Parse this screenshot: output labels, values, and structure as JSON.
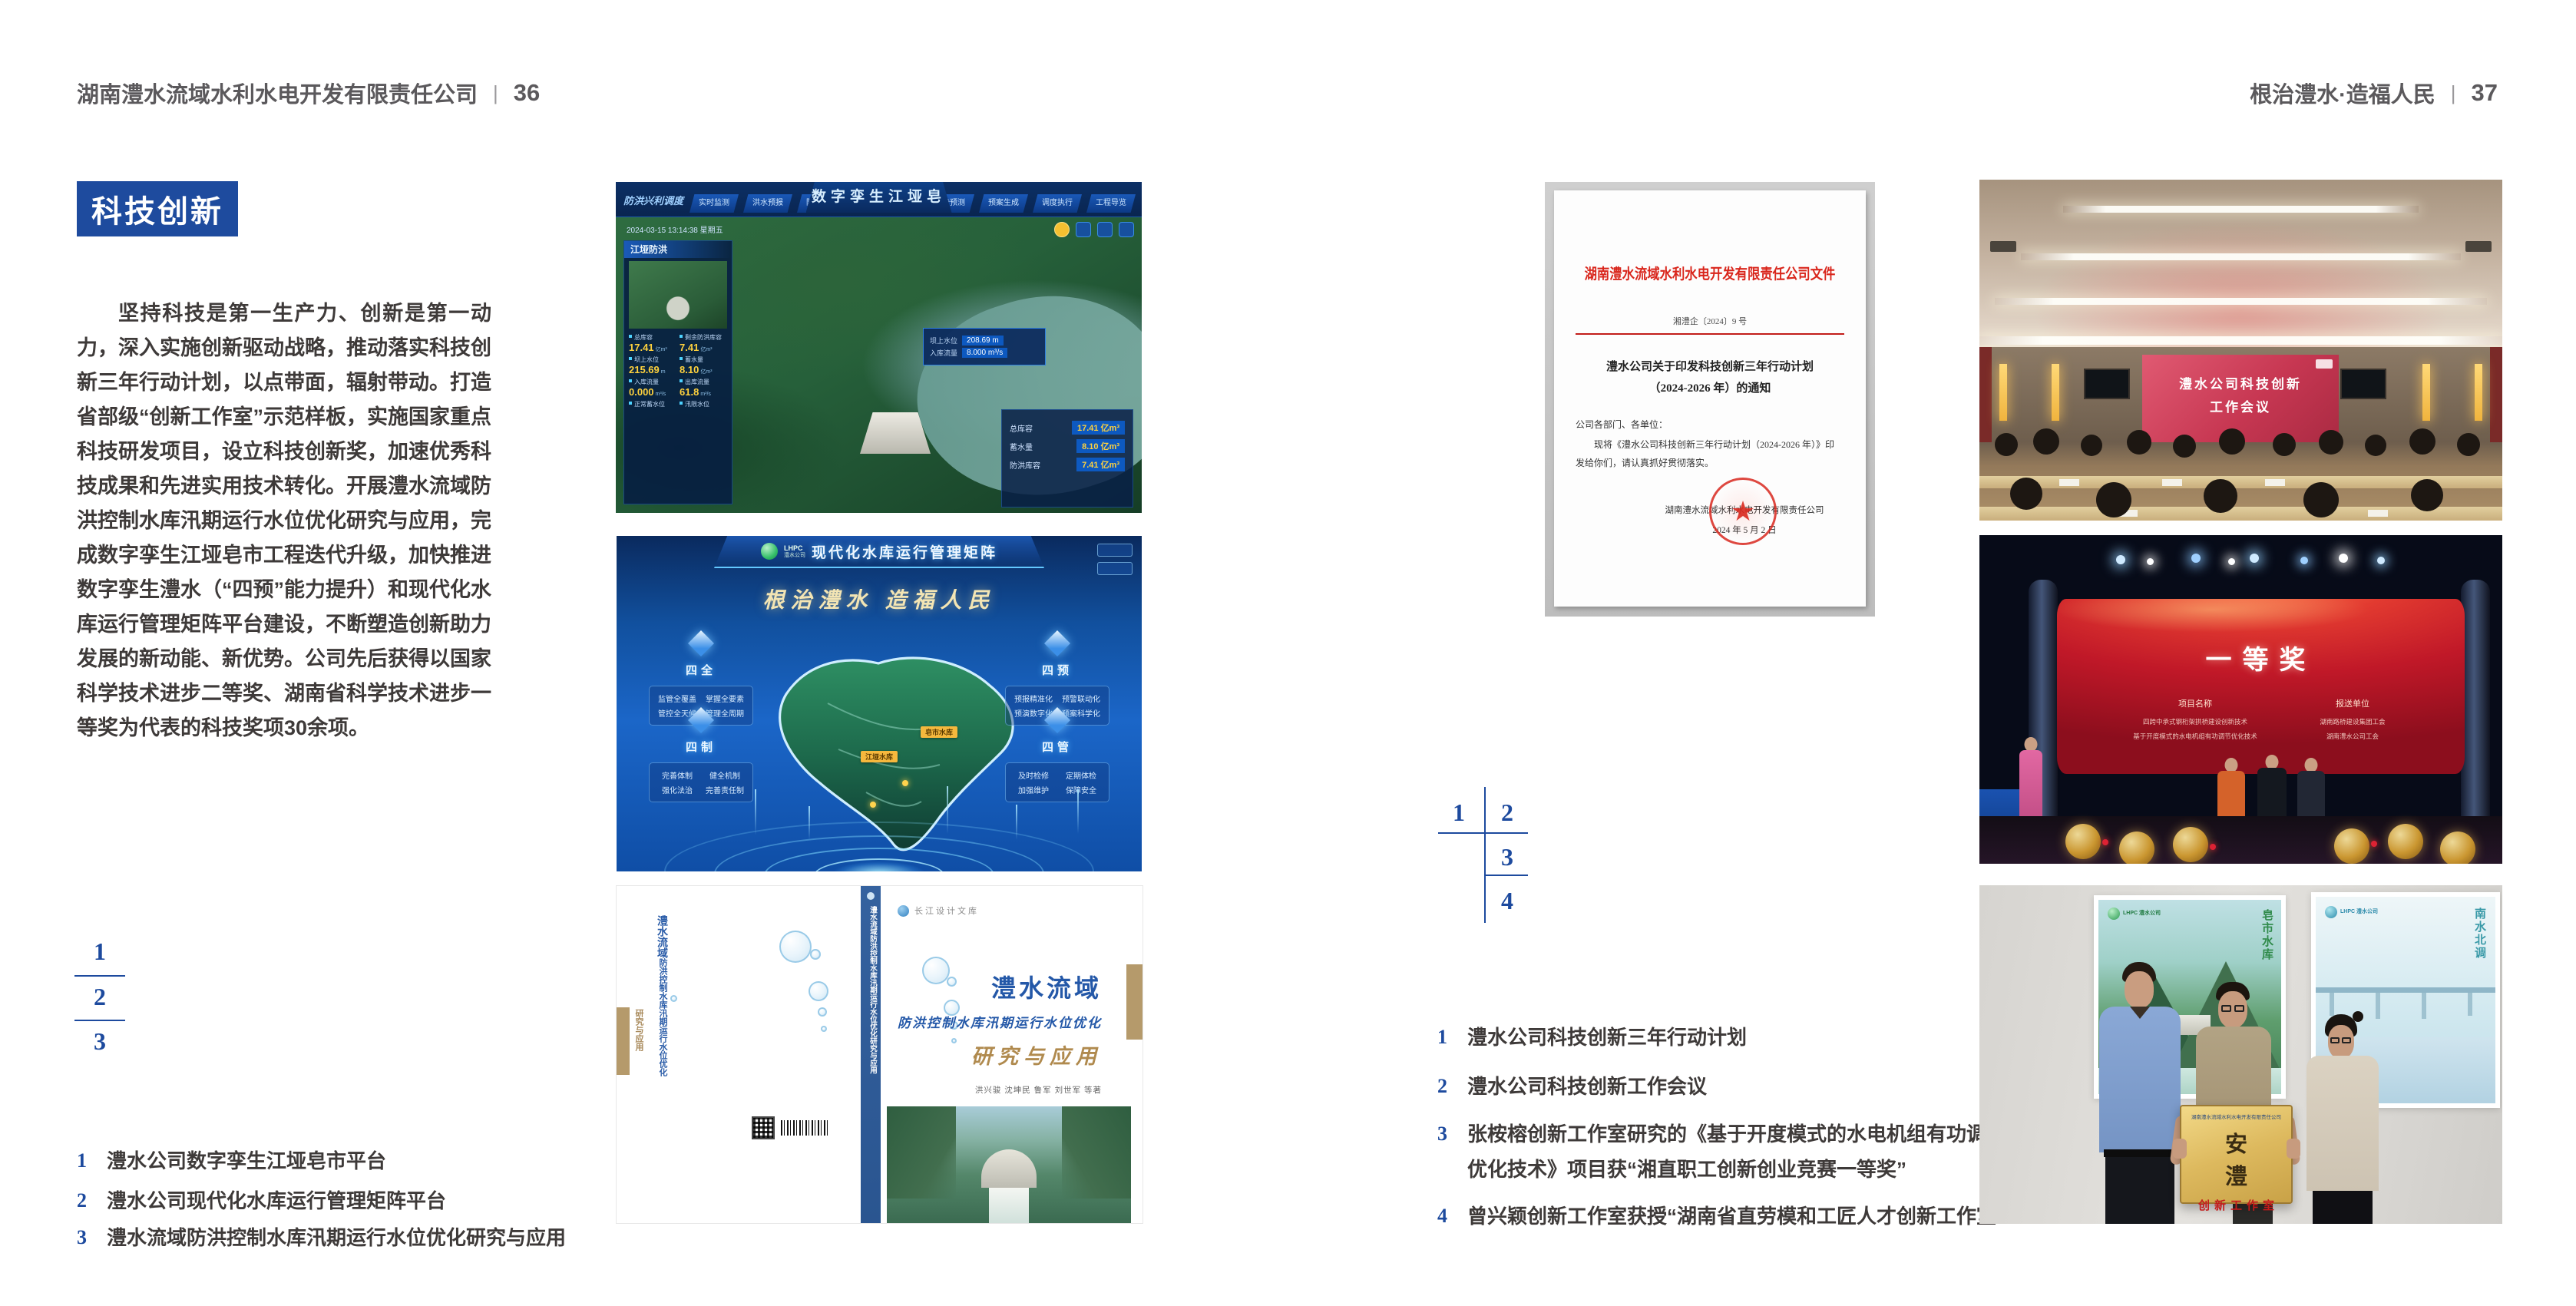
{
  "colors": {
    "accent_blue": "#1e4b9e",
    "index_blue": "#1d4a9e",
    "doc_red": "#d9261c"
  },
  "left_page": {
    "header": {
      "title": "湖南澧水流域水利水电开发有限责任公司",
      "divider": "|",
      "page_number": "36"
    },
    "badge": "科技创新",
    "paragraph": "坚持科技是第一生产力、创新是第一动力，深入实施创新驱动战略，推动落实科技创新三年行动计划，以点带面，辐射带动。打造省部级“创新工作室”示范样板，实施国家重点科技研发项目，设立科技创新奖，加速优秀科技成果和先进实用技术转化。开展澧水流域防洪控制水库汛期运行水位优化研究与应用，完成数字孪生江垭皂市工程迭代升级，加快推进数字孪生澧水（“四预”能力提升）和现代化水库运行管理矩阵平台建设，不断塑造创新助力发展的新动能、新优势。公司先后获得以国家科学技术进步二等奖、湖南省科学技术进步一等奖为代表的科技奖项30余项。",
    "figure_index": [
      "1",
      "2",
      "3"
    ],
    "captions": [
      {
        "num": "1",
        "text": "澧水公司数字孪生江垭皂市平台"
      },
      {
        "num": "2",
        "text": "澧水公司现代化水库运行管理矩阵平台"
      },
      {
        "num": "3",
        "text": "澧水流域防洪控制水库汛期运行水位优化研究与应用"
      }
    ]
  },
  "right_page": {
    "header": {
      "title": "根治澧水·造福人民",
      "divider": "|",
      "page_number": "37"
    },
    "figure_index": [
      "1",
      "2",
      "3",
      "4"
    ],
    "captions": [
      {
        "num": "1",
        "text": "澧水公司科技创新三年行动计划"
      },
      {
        "num": "2",
        "text": "澧水公司科技创新工作会议"
      },
      {
        "num": "3",
        "text": "张桉榕创新工作室研究的《基于开度模式的水电机组有功调节优化技术》项目获“湘直职工创新创业竞赛一等奖”"
      },
      {
        "num": "4",
        "text": "曾兴颖创新工作室获授“湖南省直劳模和工匠人才创新工作室”"
      }
    ]
  },
  "fig_dashboard": {
    "title": "数字孪生江垭皂市",
    "corner_label": "防洪兴利调度",
    "timestamp": "2024-03-15 13:14:38 星期五",
    "tabs_left": [
      "实时监测",
      "洪水预报",
      "防洪预警"
    ],
    "tabs_right": [
      "态势预测",
      "预案生成",
      "调度执行",
      "工程导览"
    ],
    "panel_title": "江垭防洪",
    "stats": [
      {
        "label": "总库容",
        "value": "17.41",
        "unit": "亿m³"
      },
      {
        "label": "剩余防洪库容",
        "value": "7.41",
        "unit": "亿m³"
      },
      {
        "label": "坝上水位",
        "value": "215.69",
        "unit": "m"
      },
      {
        "label": "蓄水量",
        "value": "8.10",
        "unit": "亿m³"
      },
      {
        "label": "入库流量",
        "value": "0.000",
        "unit": "m³/s"
      },
      {
        "label": "出库流量",
        "value": "61.8",
        "unit": "m³/s"
      },
      {
        "label": "正常蓄水位",
        "value": "",
        "unit": ""
      },
      {
        "label": "汛限水位",
        "value": "",
        "unit": ""
      }
    ],
    "tooltip": [
      {
        "label": "坝上水位",
        "value": "208.69 m"
      },
      {
        "label": "入库流量",
        "value": "8.000 m³/s"
      }
    ],
    "side_panel": [
      {
        "label": "总库容",
        "value": "17.41 亿m³"
      },
      {
        "label": "蓄水量",
        "value": "8.10 亿m³"
      },
      {
        "label": "防洪库容",
        "value": "7.41 亿m³"
      }
    ]
  },
  "fig_matrix": {
    "logo_acronym": "LHPC",
    "logo_company": "澧水公司",
    "title": "现代化水库运行管理矩阵",
    "slogan": "根治澧水 造福人民",
    "panels": [
      {
        "title": "四全",
        "items": [
          "监管全覆盖",
          "掌握全要素",
          "管控全天候",
          "管理全周期"
        ]
      },
      {
        "title": "四预",
        "items": [
          "预报精准化",
          "预警联动化",
          "预演数字化",
          "预案科学化"
        ]
      },
      {
        "title": "四制",
        "items": [
          "完善体制",
          "健全机制",
          "强化法治",
          "完善责任制"
        ]
      },
      {
        "title": "四管",
        "items": [
          "及时检修",
          "定期体检",
          "加强维护",
          "保障安全"
        ]
      }
    ],
    "map_labels": [
      "江垭水库",
      "皂市水库"
    ]
  },
  "fig_book": {
    "series": "长江设计文库",
    "title": "澧水流域",
    "subtitle": "防洪控制水库汛期运行水位优化",
    "subtitle2": "研究与应用",
    "authors": "洪兴骏 沈坤民 鲁军 刘世军 等著",
    "spine": "澧水流域防洪控制水库汛期运行水位优化研究与应用"
  },
  "fig_document": {
    "header": "湖南澧水流域水利水电开发有限责任公司文件",
    "doc_number": "湘澧企〔2024〕9 号",
    "title_line1": "澧水公司关于印发科技创新三年行动计划",
    "title_line2": "（2024-2026 年）的通知",
    "salutation": "公司各部门、各单位：",
    "body_line1": "现将《澧水公司科技创新三年行动计划（2024-2026 年）》印",
    "body_line2": "发给你们，请认真抓好贯彻落实。",
    "signature": "湖南澧水流域水利水电开发有限责任公司",
    "date": "2024 年 5 月 2 日",
    "seal_star": "★"
  },
  "fig_meeting": {
    "screen_line1": "澧水公司科技创新",
    "screen_line2": "工作会议"
  },
  "fig_award": {
    "title": "一等奖",
    "col1_header": "项目名称",
    "col1_items": [
      "四跨中承式钢桁架拱桥建设创新技术",
      "基于开度模式的水电机组有功调节优化技术"
    ],
    "col2_header": "报送单位",
    "col2_items": [
      "湖南路桥建设集团工会",
      "湖南澧水公司工会"
    ]
  },
  "fig_group": {
    "poster_left_logo": "LHPC 澧水公司",
    "poster_left_caption": "皂市水库",
    "poster_right_logo": "LHPC 澧水公司",
    "poster_right_caption": "南水北调",
    "plaque_org": "湖南澧水流域水利水电开发有限责任公司",
    "plaque_title": "安 澧",
    "plaque_subtitle": "创新工作室"
  }
}
